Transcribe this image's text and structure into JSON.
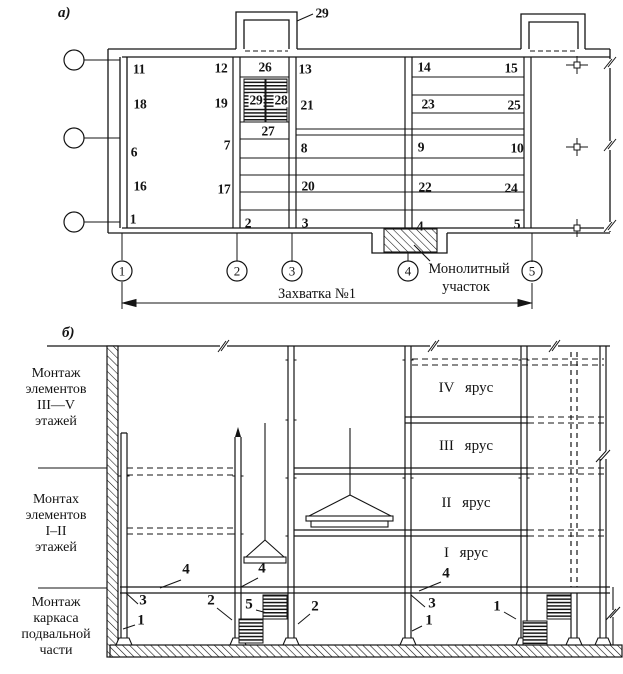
{
  "figure": {
    "panel_a": "а)",
    "panel_b": "б)",
    "plan": {
      "bay_callout": "29",
      "monolith_label_1": "Монолитный",
      "monolith_label_2": "участок",
      "dimension_label": "Захватка №1",
      "axes": [
        {
          "n": "1",
          "x": 122
        },
        {
          "n": "2",
          "x": 237
        },
        {
          "n": "3",
          "x": 292
        },
        {
          "n": "4",
          "x": 408
        },
        {
          "n": "5",
          "x": 532
        }
      ],
      "unit_labels": [
        {
          "t": "11",
          "x": 139,
          "y": 69
        },
        {
          "t": "18",
          "x": 140,
          "y": 104
        },
        {
          "t": "6",
          "x": 134,
          "y": 152
        },
        {
          "t": "16",
          "x": 140,
          "y": 186
        },
        {
          "t": "1",
          "x": 133,
          "y": 219
        },
        {
          "t": "12",
          "x": 221,
          "y": 68
        },
        {
          "t": "19",
          "x": 221,
          "y": 103
        },
        {
          "t": "7",
          "x": 227,
          "y": 145
        },
        {
          "t": "17",
          "x": 224,
          "y": 189
        },
        {
          "t": "2",
          "x": 248,
          "y": 223
        },
        {
          "t": "26",
          "x": 265,
          "y": 67
        },
        {
          "t": "27",
          "x": 268,
          "y": 131
        },
        {
          "t": "3",
          "x": 305,
          "y": 223
        },
        {
          "t": "13",
          "x": 305,
          "y": 69
        },
        {
          "t": "21",
          "x": 307,
          "y": 105
        },
        {
          "t": "8",
          "x": 304,
          "y": 148
        },
        {
          "t": "20",
          "x": 308,
          "y": 186
        },
        {
          "t": "14",
          "x": 424,
          "y": 67
        },
        {
          "t": "15",
          "x": 511,
          "y": 68
        },
        {
          "t": "23",
          "x": 428,
          "y": 104
        },
        {
          "t": "25",
          "x": 514,
          "y": 105
        },
        {
          "t": "9",
          "x": 421,
          "y": 147
        },
        {
          "t": "10",
          "x": 517,
          "y": 148
        },
        {
          "t": "22",
          "x": 425,
          "y": 187
        },
        {
          "t": "24",
          "x": 511,
          "y": 188
        },
        {
          "t": "4",
          "x": 420,
          "y": 226
        },
        {
          "t": "5",
          "x": 517,
          "y": 224
        }
      ],
      "stair_labels": [
        {
          "t": "29",
          "x": 256,
          "y": 100
        },
        {
          "t": "28",
          "x": 281,
          "y": 100
        }
      ]
    },
    "section": {
      "stages": [
        {
          "top": 366,
          "lines": [
            "Монтаж",
            "элементов",
            "III—V",
            "этажей"
          ]
        },
        {
          "top": 492,
          "lines": [
            "Монтах",
            "элементов",
            "I–II",
            "этажей"
          ]
        },
        {
          "top": 595,
          "lines": [
            "Монтаж",
            "каркаса",
            "подвальной",
            "части"
          ]
        }
      ],
      "tiers": [
        {
          "t": "IV ярус",
          "top": 381
        },
        {
          "t": "III ярус",
          "top": 439
        },
        {
          "t": "II ярус",
          "top": 496
        },
        {
          "t": "I ярус",
          "top": 546
        }
      ],
      "callouts": [
        {
          "t": "4",
          "x": 186,
          "y": 570
        },
        {
          "t": "4",
          "x": 262,
          "y": 569
        },
        {
          "t": "4",
          "x": 446,
          "y": 574
        },
        {
          "t": "3",
          "x": 143,
          "y": 601
        },
        {
          "t": "3",
          "x": 432,
          "y": 604
        },
        {
          "t": "2",
          "x": 211,
          "y": 601
        },
        {
          "t": "2",
          "x": 315,
          "y": 607
        },
        {
          "t": "5",
          "x": 249,
          "y": 605
        },
        {
          "t": "1",
          "x": 141,
          "y": 621
        },
        {
          "t": "1",
          "x": 429,
          "y": 621
        },
        {
          "t": "1",
          "x": 497,
          "y": 607
        }
      ]
    }
  }
}
